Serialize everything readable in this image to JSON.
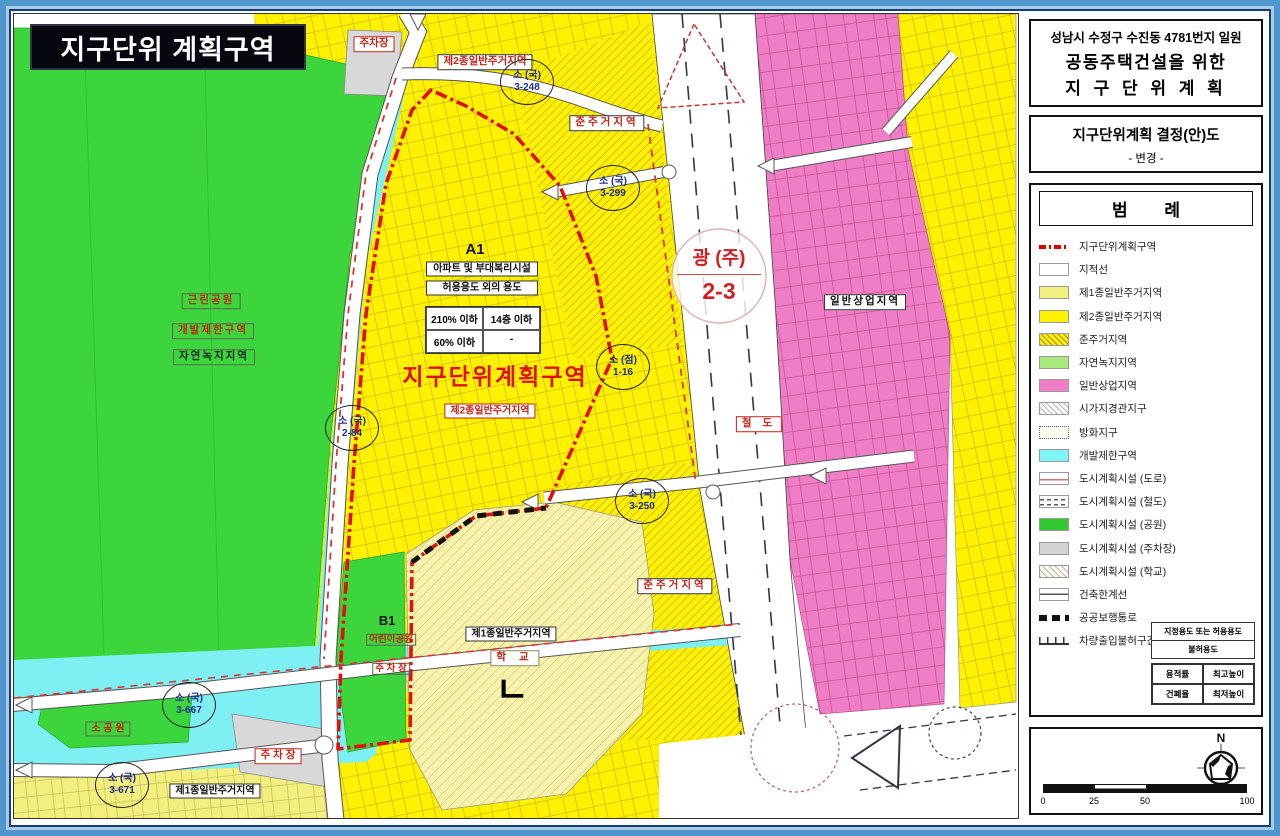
{
  "map": {
    "colors": {
      "green": "#3CD63C",
      "cyan": "#7EF0F4",
      "yellow": "#FFF100",
      "yellow_light": "#F2EF7E",
      "pink": "#F07EC6",
      "gray": "#D8D8D8",
      "school_cream": "#F7F2AC",
      "boundary_red": "#E01010",
      "road_white": "#FFFFFF"
    },
    "overlay_title": "지구단위 계획구역",
    "labels": {
      "parking_top": "주차장",
      "zone2_top": "제2종일반주거지역",
      "semi_res_top": "준주거지역",
      "a1": "A1",
      "info_line1": "아파트 및 부대복리시설",
      "info_line2": "허용용도 외의 용도",
      "far_limit": "210% 이하",
      "floor_limit": "14층 이하",
      "bcr_limit": "60% 이하",
      "dash": "-",
      "district_title": "지구단위계획구역",
      "zone2_mid": "제2종일반주거지역",
      "park": "근린공원",
      "greenbelt": "개발제한구역",
      "nature": "자연녹지지역",
      "railway": "철 도",
      "commercial": "일반상업지역",
      "semi_res_bottom": "준주거지역",
      "b1": "B1",
      "children_park": "어린이공원",
      "parking_b1": "주 차 장",
      "zone1_school": "제1종일반주거지역",
      "school": "학 교",
      "school_mark": "ㄴ",
      "small_park": "소 공 원",
      "parking_bottom": "주 차 장",
      "zone1_bottom": "제1종일반주거지역"
    },
    "circles": {
      "c3248": {
        "top": "소 (국)",
        "bottom": "3-248"
      },
      "c3299": {
        "top": "소 (국)",
        "bottom": "3-299"
      },
      "c116": {
        "top": "소 (점)",
        "bottom": "1-16"
      },
      "c284": {
        "top": "소 (국)",
        "bottom": "2-84"
      },
      "c3250": {
        "top": "소 (국)",
        "bottom": "3-250"
      },
      "c3667": {
        "top": "소 (국)",
        "bottom": "3-667"
      },
      "c3671": {
        "top": "소 (국)",
        "bottom": "3-671"
      },
      "gwang": {
        "top": "광 (주)",
        "bottom": "2-3"
      }
    }
  },
  "panel": {
    "title_lines": [
      "성남시 수정구 수진동 4781번지 일원",
      "공동주택건설을 위한",
      "지 구 단 위 계 획"
    ],
    "subtitle": "지구단위계획 결정(안)도",
    "subtitle_note": "- 변경 -",
    "legend": {
      "header": "범  례",
      "items": [
        "지구단위계획구역",
        "지적선",
        "제1종일반주거지역",
        "제2종일반주거지역",
        "준주거지역",
        "자연녹지지역",
        "일반상업지역",
        "시가지경관지구",
        "방화지구",
        "개발제한구역",
        "도시계획시설 (도로)",
        "도시계획시설 (철도)",
        "도시계획시설 (공원)",
        "도시계획시설 (주차장)",
        "도시계획시설 (학교)",
        "건축한계선",
        "공공보행통로",
        "차량출입불허구간"
      ],
      "use_table": [
        "지정용도 또는 허용용도",
        "불허용도"
      ],
      "ratio_table": [
        [
          "용적률",
          "최고높이"
        ],
        [
          "건폐율",
          "최저높이"
        ]
      ]
    },
    "compass_label": "N",
    "scale_ticks": [
      "0",
      "25",
      "50",
      "100"
    ]
  }
}
